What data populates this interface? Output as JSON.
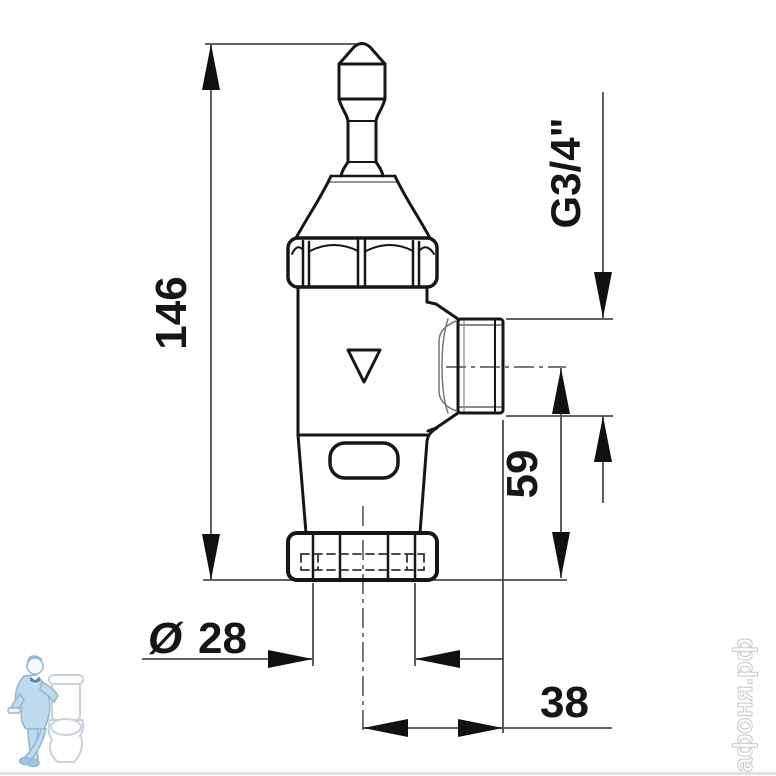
{
  "drawing": {
    "kind": "flush-valve side-view technical drawing",
    "outline_color": "#161616",
    "dimension_line_color": "#4d4d4d",
    "background_color": "#ffffff"
  },
  "dimensions": {
    "overall_height": "146",
    "thread_size": "G3/4\"",
    "outlet_axis_to_base": "59",
    "diameter_symbol": "Ø",
    "diameter_value": "28",
    "axis_to_outlet_face": "38"
  },
  "watermarks": {
    "site_text": "афоня.рф",
    "plumber_suit_color": "#bdd8eb",
    "plumber_line_color": "#8fb6d3",
    "toilet_line_color": "#c6cfdb"
  }
}
